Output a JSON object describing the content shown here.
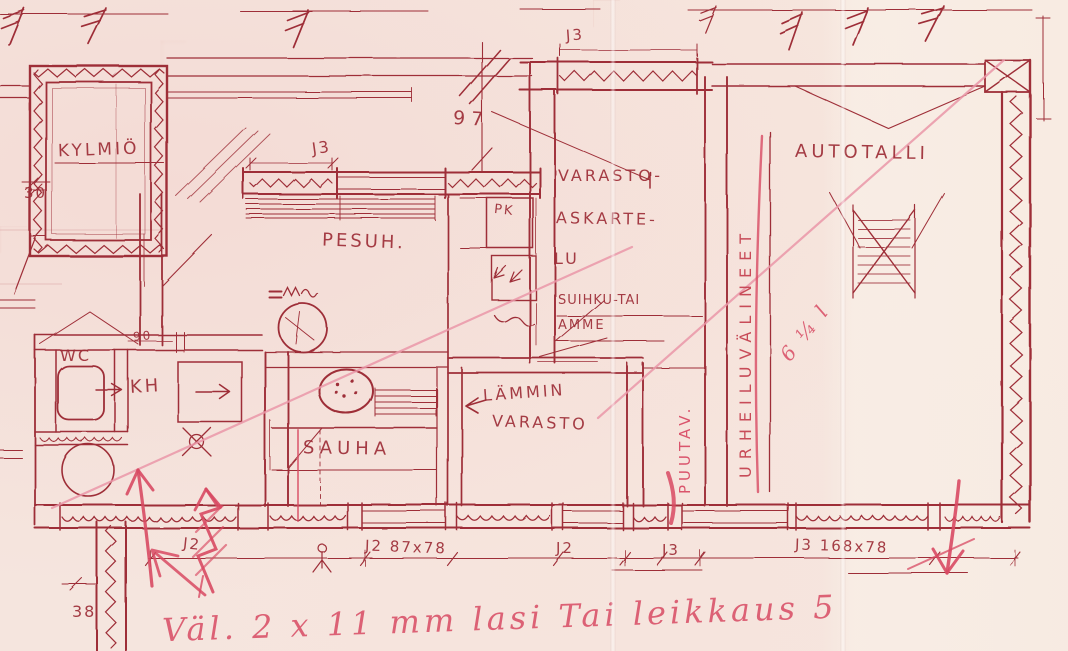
{
  "document": {
    "kind": "Hand-drawn floor plan sketch",
    "language": "Finnish"
  },
  "palette": {
    "paper": "#f5e5de",
    "ink": "#9e2f38",
    "marker": "#d84a63",
    "marker_soft": "#ea96a8",
    "grid": "#eac6c0"
  },
  "rooms": {
    "kylmio": {
      "label": "KYLMIÖ"
    },
    "pesuhuone": {
      "label": "PESUH."
    },
    "wc": {
      "label": "WC"
    },
    "kylpyhuone": {
      "label": "KH"
    },
    "sauna": {
      "label": "SAUHA"
    },
    "lammin_varasto": {
      "line1": "LÄMMIN",
      "line2": "VARASTO"
    },
    "varasto_askartelu": {
      "line1": "VARASTO-",
      "line2": "ASKARTE-",
      "line3": "LU"
    },
    "suihku_tai_amme": {
      "line1": "SUIHKU-TAI",
      "line2": "AMME"
    },
    "autotalli": {
      "label": "AUTOTALLI"
    },
    "urheiluvalineet": {
      "label": "URHEILUVÄLINEET"
    },
    "puutavara": {
      "label": "PUUTAV."
    },
    "pukukaappi": {
      "label": "PK"
    }
  },
  "dimensions": {
    "left_wall": "30",
    "door_wc": "90",
    "window_top": "97",
    "corner_bottom": "38",
    "j3_pesuh_window": "J3",
    "j3_varasto_window": "J3",
    "j2_left": "J2",
    "j2_mid": "J2 87x78",
    "j2_right": "J2",
    "j3_bottom": "J3",
    "j3_garage": "J3 168x78"
  },
  "annotations": {
    "bottom_note": "Väl. 2 x 11 mm lasi Tai leikkaus 5",
    "fold_note": "6 ¼ l"
  }
}
